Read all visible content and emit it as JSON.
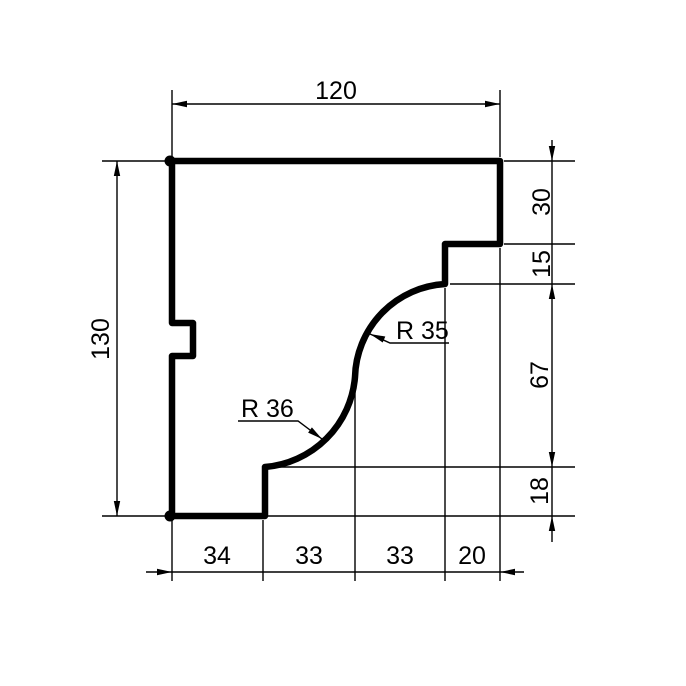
{
  "drawing": {
    "kind": "technical-drawing",
    "background_color": "#ffffff",
    "line_color": "#000000",
    "dimensions": {
      "top_width": "120",
      "left_height": "130",
      "right_chain": [
        "30",
        "15",
        "67",
        "18"
      ],
      "bottom_chain": [
        "34",
        "33",
        "33",
        "20"
      ],
      "radius_upper": "R 35",
      "radius_lower": "R 36"
    }
  }
}
